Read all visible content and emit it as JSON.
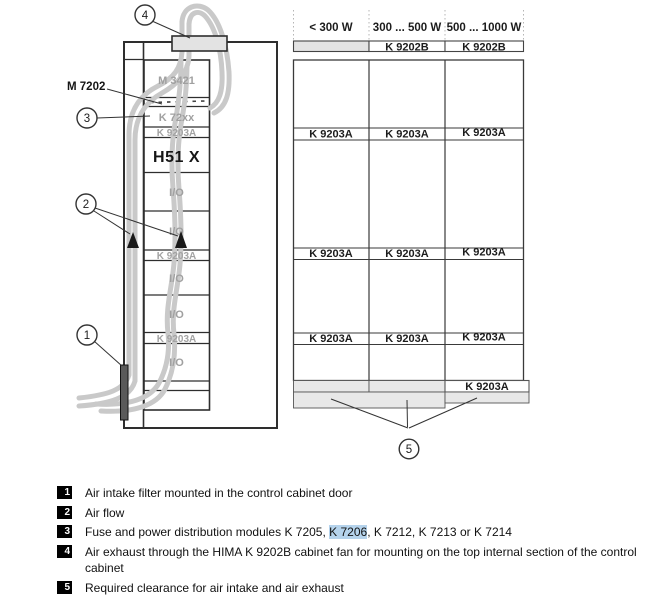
{
  "figure": {
    "description": "Control cabinet ventilation diagram with fan selection table"
  },
  "cabinet": {
    "external_label": "M 7202",
    "modules": {
      "m3421": "M 3421",
      "k72xx": "K 72xx",
      "k9203a": "K 9203A",
      "h51x": "H51 X",
      "io": "I/O"
    }
  },
  "callouts": {
    "c1": "1",
    "c2": "2",
    "c3": "3",
    "c4": "4",
    "c5": "5"
  },
  "table": {
    "headers": [
      "< 300 W",
      "300 ... 500 W",
      "500 ... 1000 W"
    ],
    "top_row": {
      "col1": "",
      "col2": "K 9202B",
      "col3": "K 9202B"
    },
    "fan_row": {
      "col1": "K 9203A",
      "col2": "K 9203A",
      "col3": "K 9203A"
    },
    "bottom_row": {
      "col1": "",
      "col2": "",
      "col3": "K 9203A"
    }
  },
  "legend": {
    "items": [
      {
        "num": "1",
        "text": "Air intake filter mounted in the control cabinet door"
      },
      {
        "num": "2",
        "text": "Air flow"
      },
      {
        "num": "3",
        "pre": "Fuse and power distribution modules K 7205, ",
        "highlight": "K 7206",
        "post": ", K 7212, K 7213 or K 7214"
      },
      {
        "num": "4",
        "text": "Air exhaust through the HIMA K 9202B cabinet fan for mounting on the top internal section of the control cabinet"
      },
      {
        "num": "5",
        "text": "Required clearance for air intake and air exhaust"
      }
    ]
  },
  "colors": {
    "shade_gray": "#e3e3e3",
    "airflow_gray": "#c9c9c9",
    "module_text_gray": "#a0a0a0",
    "selection_highlight": "#b5d3ec",
    "line_dark": "#333333"
  }
}
